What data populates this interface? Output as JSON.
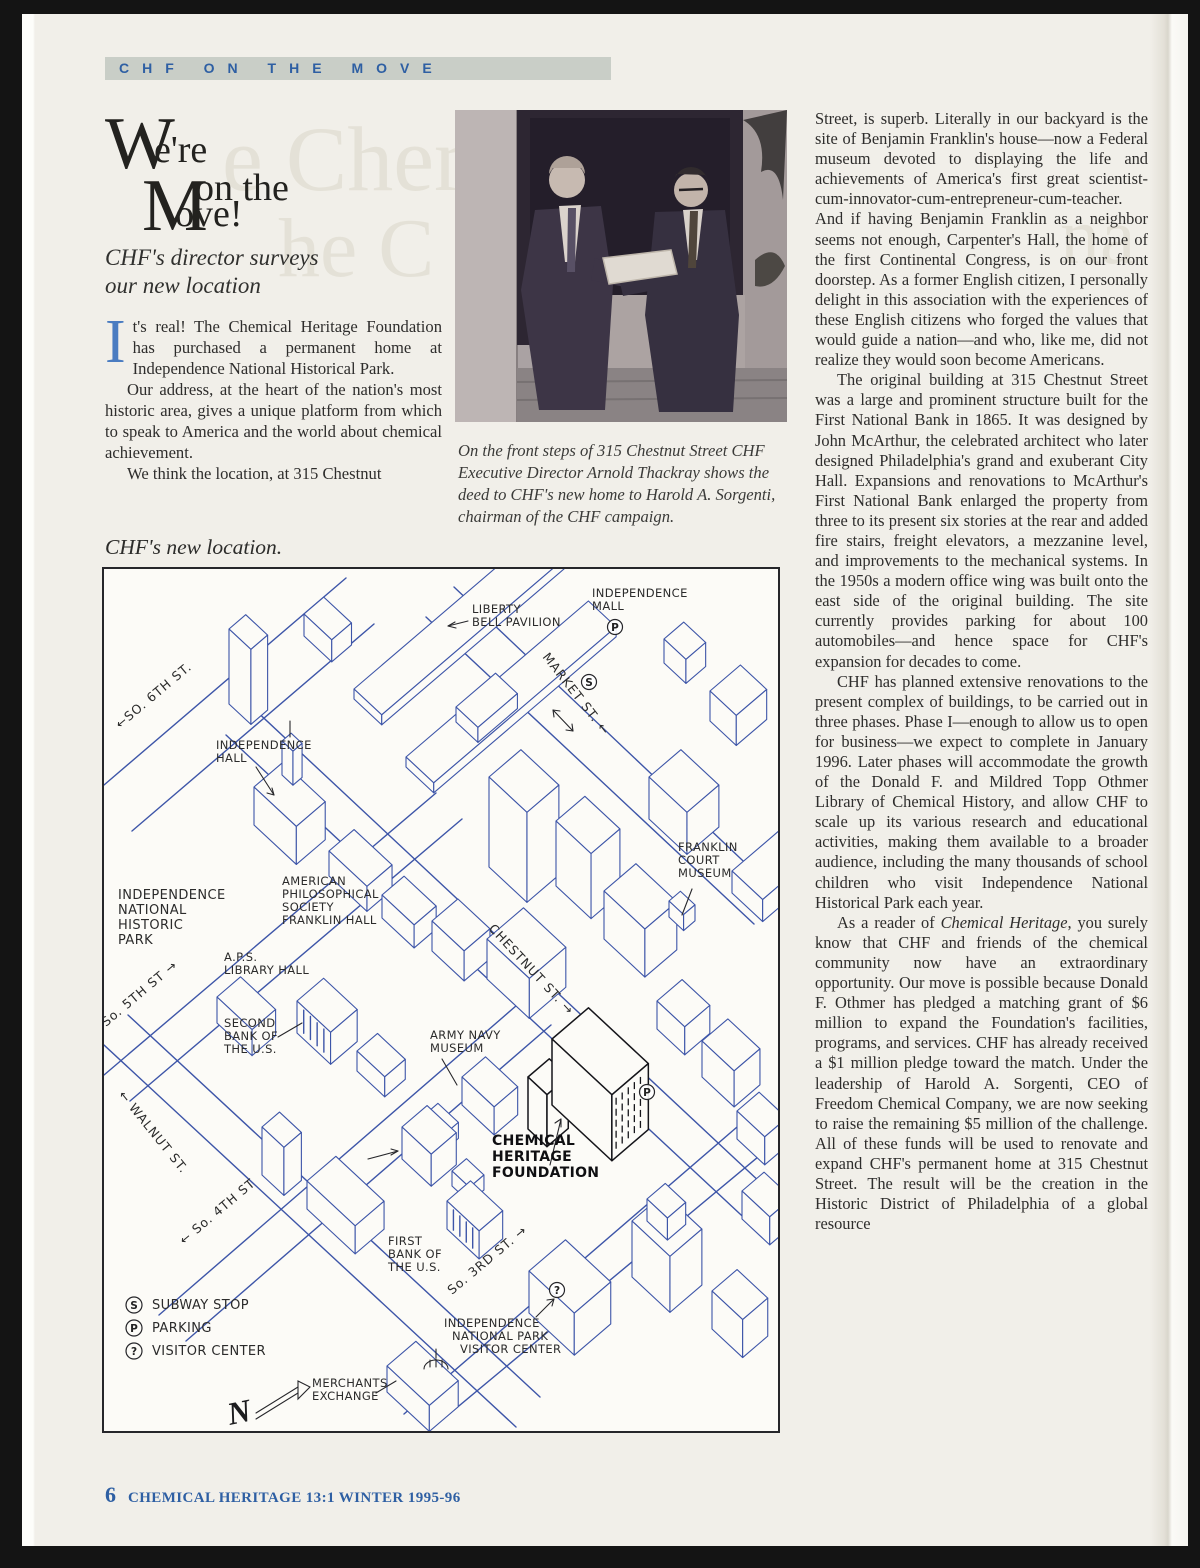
{
  "banner": {
    "title": "CHF ON THE MOVE"
  },
  "ghost": {
    "a": "e Chem",
    "b": "he C",
    "c": "na"
  },
  "title": {
    "cap1": "W",
    "rest1": "e're",
    "cap2": "M",
    "top2": "on the",
    "rest2": "ove!"
  },
  "subtitle": {
    "line1": "CHF's director surveys",
    "line2": "our  new location"
  },
  "left_column": {
    "dropcap": "I",
    "p1_rest": "t's real! The Chemical Heritage Foundation has purchased a permanent home at Independence National Historical Park.",
    "p2": "Our address, at the heart of the nation's most historic area, gives a unique platform from which to speak to America and the world about chemical achievement.",
    "p3": "We think the location, at 315 Chestnut"
  },
  "map_caption": "CHF's new location.",
  "photo": {
    "caption": "On the front steps of 315 Chestnut Street CHF Executive Director Arnold Thackray shows the deed to CHF's new home to Harold A. Sorgenti, chairman of the CHF campaign."
  },
  "right_column": {
    "p1": "Street, is superb. Literally in our backyard is the site of Benjamin Franklin's house—now a Federal museum devoted to displaying the life and achievements of America's first great scientist-cum-innovator-cum-entrepreneur-cum-teacher. And if having Benjamin Franklin as a neighbor seems not enough, Carpenter's Hall, the home of the first Continental Congress, is on our front doorstep. As a former English citizen, I personally delight in this association with the experiences of these English citizens who forged the values that would guide a nation—and who, like me, did not realize they would soon become Americans.",
    "p2": "The original building at 315 Chestnut Street was a large and prominent structure built for the First National Bank in 1865. It was designed by John McArthur, the celebrated architect who later designed Philadelphia's grand and exuberant City Hall. Expansions and renovations to McArthur's First National Bank enlarged the property from three to its present six stories at the rear and added fire stairs, freight elevators, a mezzanine level, and improvements to the mechanical systems. In the 1950s a modern office wing was built onto the east side of the original building. The site currently provides parking for about 100 automobiles—and hence space for CHF's expansion for decades to come.",
    "p3": "CHF has planned extensive renovations to the present complex of buildings, to be carried out in three phases. Phase I—enough to allow us to open for business—we expect to complete in January 1996. Later phases will accommodate the growth of the Donald F. and Mildred Topp Othmer Library of Chemical History, and allow CHF to scale up its various research and educational activities, making them available to a broader audience, including the many thousands of school children who visit Independence National Historical Park each year.",
    "p4_prefix": "As a reader of ",
    "p4_italic": "Chemical Heritage",
    "p4_suffix": ", you surely know that CHF and friends of the chemical community now have an extraordinary opportunity. Our move is possible because Donald F. Othmer has pledged a matching grant of $6 million to expand the Foundation's facilities, programs, and services. CHF has already received a $1 million pledge toward the match. Under the leadership of Harold A. Sorgenti, CEO of Freedom Chemical Company, we are now seeking to raise the remaining $5 million of the challenge. All of these funds will be used to renovate and expand CHF's permanent home at 315 Chestnut Street. The result will be the creation in the Historic District of Philadelphia of a global resource"
  },
  "map": {
    "places": [
      {
        "id": "independence-mall",
        "lines": [
          "INDEPENDENCE",
          "MALL"
        ]
      },
      {
        "id": "liberty-bell-pavilion",
        "lines": [
          "LIBERTY",
          "BELL PAVILION"
        ]
      },
      {
        "id": "independence-hall",
        "lines": [
          "INDEPENDENCE",
          "HALL"
        ]
      },
      {
        "id": "independence-national-historic-park",
        "lines": [
          "INDEPENDENCE",
          "NATIONAL",
          "HISTORIC",
          "PARK"
        ]
      },
      {
        "id": "american-philosophical-society",
        "lines": [
          "AMERICAN",
          "PHILOSOPHICAL",
          "SOCIETY",
          "FRANKLIN HALL"
        ]
      },
      {
        "id": "aps-library-hall",
        "lines": [
          "A.P.S.",
          "LIBRARY HALL"
        ]
      },
      {
        "id": "second-bank",
        "lines": [
          "SECOND",
          "BANK OF",
          "THE U.S."
        ]
      },
      {
        "id": "franklin-court-museum",
        "lines": [
          "FRANKLIN",
          "COURT",
          "MUSEUM"
        ]
      },
      {
        "id": "army-navy-museum",
        "lines": [
          "ARMY NAVY",
          "MUSEUM"
        ]
      },
      {
        "id": "chemical-heritage-foundation",
        "lines": [
          "CHEMICAL",
          "HERITAGE",
          "FOUNDATION"
        ]
      },
      {
        "id": "first-bank",
        "lines": [
          "FIRST",
          "BANK OF",
          "THE U.S."
        ]
      },
      {
        "id": "independence-visitor-center",
        "lines": [
          "INDEPENDENCE",
          "NATIONAL PARK",
          "VISITOR CENTER"
        ]
      },
      {
        "id": "merchants-exchange",
        "lines": [
          "MERCHANTS",
          "EXCHANGE"
        ]
      }
    ],
    "streets": [
      {
        "id": "market-st",
        "name": "MARKET ST. ←"
      },
      {
        "id": "chestnut-st",
        "name": "CHESTNUT ST. →"
      },
      {
        "id": "so-6th-st",
        "name": "←SO. 6TH ST."
      },
      {
        "id": "so-5th-st",
        "name": "So. 5TH ST →"
      },
      {
        "id": "walnut-st",
        "name": "← WALNUT ST."
      },
      {
        "id": "so-4th-st",
        "name": "← So. 4TH ST"
      },
      {
        "id": "so-3rd-st",
        "name": "So. 3RD ST. →"
      }
    ],
    "legend": [
      {
        "symbol": "S",
        "label": "SUBWAY STOP"
      },
      {
        "symbol": "P",
        "label": "PARKING"
      },
      {
        "symbol": "?",
        "label": "VISITOR CENTER"
      }
    ],
    "symbols": [
      {
        "id": "s-market",
        "letter": "S"
      },
      {
        "id": "p-mall",
        "letter": "P"
      },
      {
        "id": "p-chf",
        "letter": "P"
      },
      {
        "id": "q-visitor",
        "letter": "?"
      }
    ],
    "compass": "N"
  },
  "footer": {
    "page_number": "6",
    "text": "CHEMICAL HERITAGE 13:1 WINTER 1995-96"
  },
  "colors": {
    "accent_blue": "#2e5fa3",
    "dropcap_blue": "#4a7cc1",
    "banner_bg": "#c9cec7",
    "map_ink_blue": "#3d55a8",
    "page_bg": "#f1efe9"
  }
}
